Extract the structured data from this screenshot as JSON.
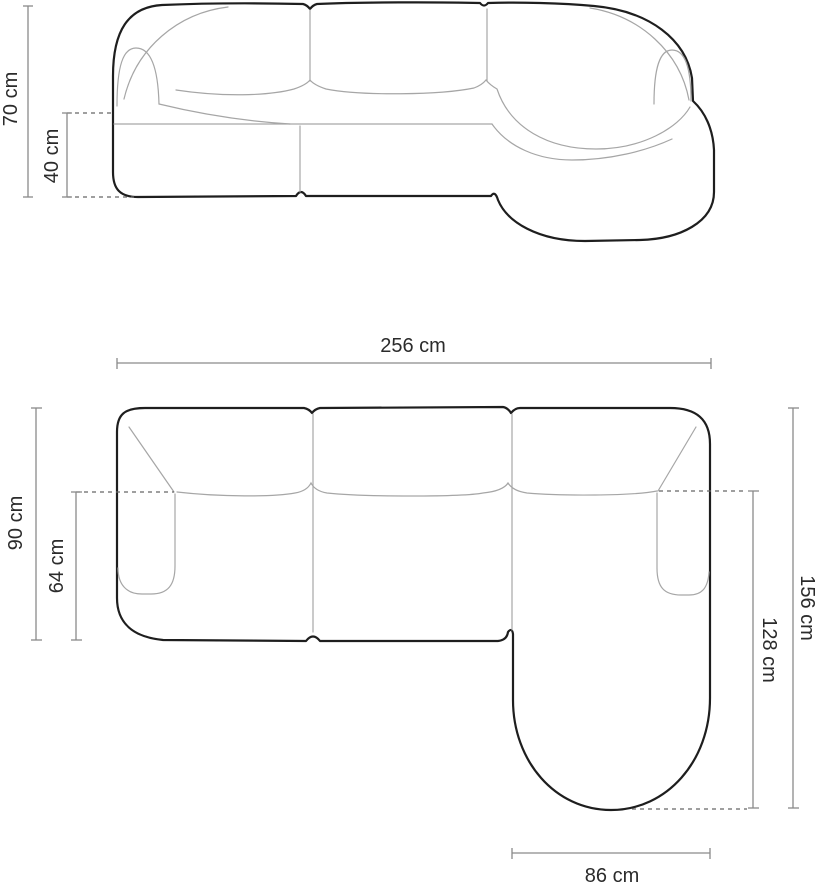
{
  "colors": {
    "outline": "#1e1e1e",
    "detail": "#a6a6a6",
    "dimension": "#8a8a8a",
    "dash": "#666666",
    "label": "#2b2b2b",
    "background": "#ffffff"
  },
  "front_view": {
    "height_label": "70 cm",
    "seat_height_label": "40 cm"
  },
  "top_view": {
    "width_label": "256 cm",
    "depth_label": "90 cm",
    "seat_depth_label": "64 cm",
    "total_depth_label": "156 cm",
    "chaise_depth_label": "128 cm",
    "chaise_width_label": "86 cm"
  }
}
